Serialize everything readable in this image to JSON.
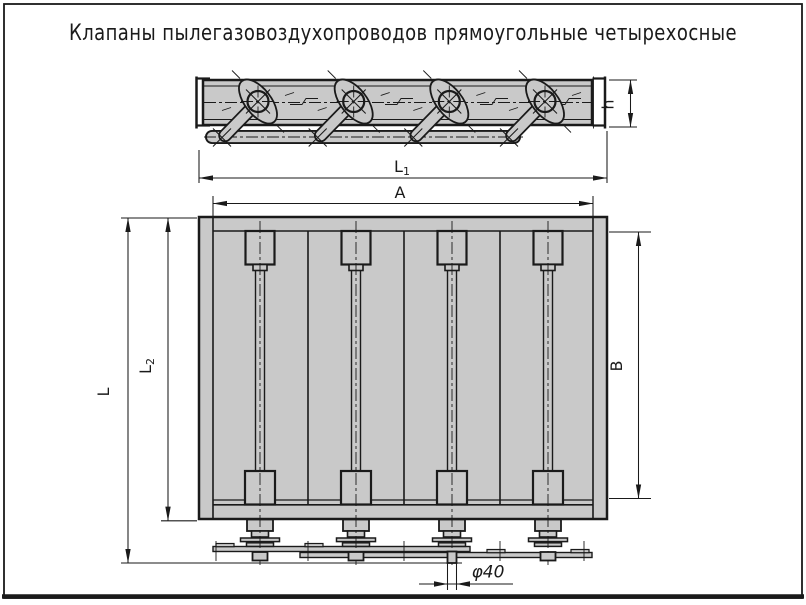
{
  "title": "Клапаны пылегазовоздухопроводов прямоугольные четырехосные",
  "colors": {
    "metal": "#c9c9c9",
    "ink": "#1a1a1a",
    "bg": "#ffffff"
  },
  "dims": {
    "L1": {
      "base": "L",
      "sub": "1"
    },
    "A": {
      "label": "A"
    },
    "L": {
      "label": "L"
    },
    "L2": {
      "base": "L",
      "sub": "2"
    },
    "B": {
      "label": "B"
    },
    "h": {
      "label": "h"
    },
    "d40": {
      "label": "φ40"
    }
  }
}
